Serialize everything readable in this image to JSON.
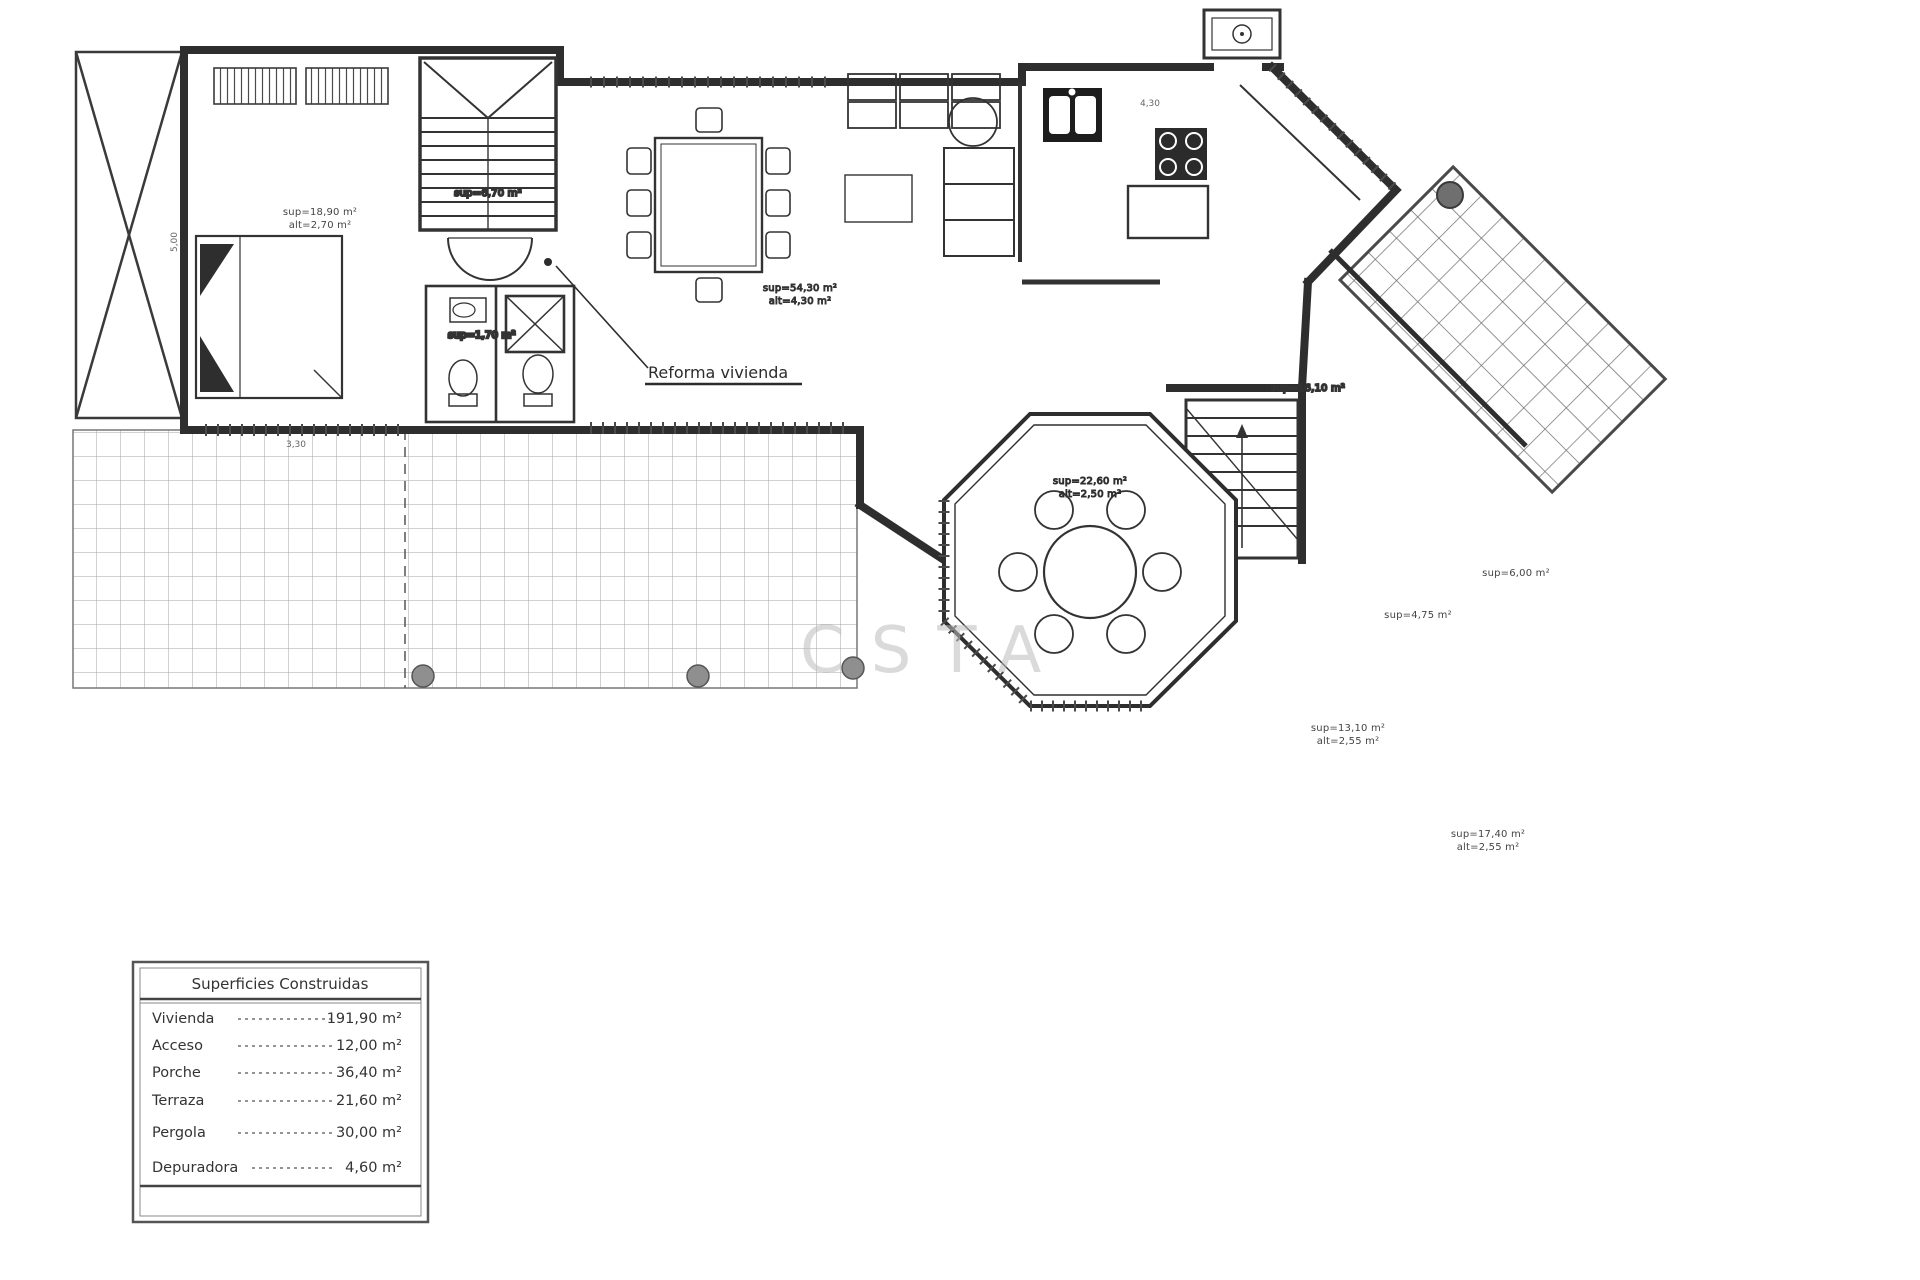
{
  "colors": {
    "ink": "#2e2e2e",
    "line_light": "#8c8c8c",
    "tile": "#a3a3a3",
    "post_fill": "#8f8f8f",
    "fixture_dark": "#1d1d1d",
    "background": "#ffffff"
  },
  "plan": {
    "annotation": {
      "reforma_label": "Reforma vivienda"
    },
    "watermark_text": "CSTA",
    "rooms": {
      "bedroom1": {
        "line1": "sup=18,90 m²",
        "line2": "alt=2,70 m²"
      },
      "stairs": {
        "line1": "sup=6,70 m²"
      },
      "bath_small": {
        "line1": "sup=1,70 m²"
      },
      "living": {
        "line1": "sup=54,30 m²",
        "line2": "alt=4,30 m²"
      },
      "hall_stairs": {
        "line1": "sup=16,10 m²"
      },
      "dining_octagon": {
        "line1": "sup=22,60 m²",
        "line2": "alt=2,50 m²"
      },
      "distributor": {
        "line1": "sup=4,75 m²"
      },
      "bathroom_right": {
        "line1": "sup=6,00 m²"
      },
      "bedroom2": {
        "line1": "sup=13,10 m²",
        "line2": "alt=2,55 m²"
      },
      "bedroom3": {
        "line1": "sup=17,40 m²",
        "line2": "alt=2,55 m²"
      }
    },
    "dimensions": [
      {
        "text": "4,30"
      },
      {
        "text": "3,30"
      },
      {
        "text": "5,00"
      }
    ]
  },
  "legend": {
    "title": "Superficies Construidas",
    "rows": [
      {
        "label": "Vivienda",
        "value": "191,90 m²"
      },
      {
        "label": "Acceso",
        "value": "12,00 m²"
      },
      {
        "label": "Porche",
        "value": "36,40 m²"
      },
      {
        "label": "Terraza",
        "value": "21,60 m²"
      },
      {
        "label": "Pergola",
        "value": "30,00 m²"
      },
      {
        "label": "Depuradora",
        "value": "4,60 m²"
      }
    ]
  }
}
